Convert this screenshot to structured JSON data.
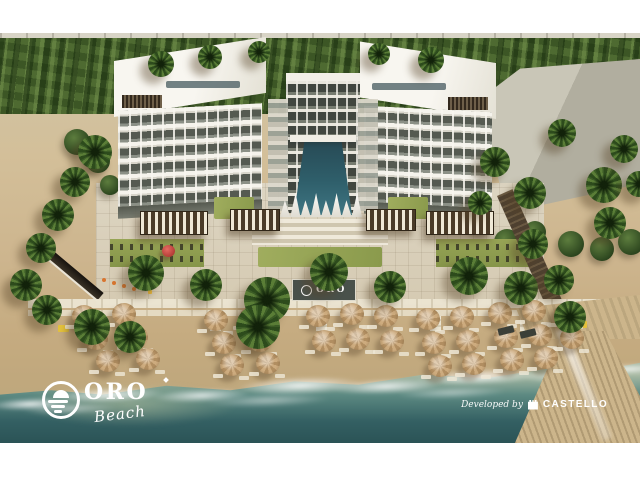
{
  "scene": {
    "type": "aerial-architectural-rendering",
    "subject": "Beachfront resort: U-shaped white residence with central courtyard pool, amenity deck with pergolas and lawns, palm-lined private beach with tan umbrella clusters, turquoise sea and wooden pier"
  },
  "branding": {
    "logo": {
      "name": "ORO",
      "script": "Beach"
    },
    "beach_sign": {
      "text": "ORO"
    },
    "developer": {
      "prefix": "Developed by",
      "name": "CASTELLO"
    }
  },
  "palette": {
    "frame": "#ffffff",
    "sea_deep": "#2b5356",
    "sea_shallow": "#9db5a5",
    "sand": "#cdb58e",
    "foliage_dark": "#2e4a20",
    "foliage_light": "#5c8038",
    "building_white": "#f5f3ec",
    "window_dark": "#555a51",
    "pool_teal": "#2f5f6b",
    "umbrella_tan": "#c7a67b",
    "pergola_brown": "#4a3b28",
    "lawn_green": "#97a455",
    "pier_wood": "#c4ae87",
    "text_white": "#ffffff"
  }
}
